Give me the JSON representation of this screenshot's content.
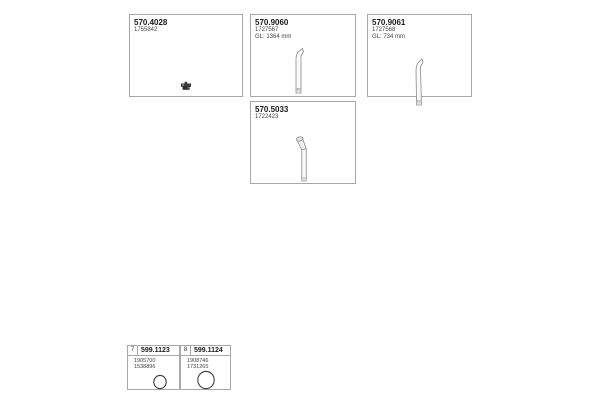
{
  "colors": {
    "border": "#a8a8a8",
    "text": "#1a1a1a",
    "secondary_text": "#444444",
    "drawing_stroke": "#8a8a8a",
    "drawing_fill": "#fafafa",
    "drawing_shade": "#cfcfcf",
    "dark_icon": "#3a3a3a"
  },
  "boxes": [
    {
      "part_number": "570.4028",
      "oem_number": "1755842",
      "icon": "clamp-icon"
    },
    {
      "part_number": "570.9060",
      "oem_number": "1727567",
      "length_note": "GL: 1364 mm",
      "icon": "straight-pipe-drawing"
    },
    {
      "part_number": "570.9061",
      "oem_number": "1727568",
      "length_note": "GL: 734 mm",
      "icon": "tail-pipe-drawing"
    },
    {
      "part_number": "570.5033",
      "oem_number": "1722423",
      "icon": "bent-pipe-drawing"
    }
  ],
  "bottom_boxes": [
    {
      "index": "7",
      "part_number": "599.1123",
      "oem_numbers": [
        "1905700",
        "1538896"
      ],
      "icon": "gasket-ring-drawing"
    },
    {
      "index": "8",
      "part_number": "599.1124",
      "oem_numbers": [
        "1908746",
        "1731265"
      ],
      "icon": "gasket-ring-drawing"
    }
  ]
}
